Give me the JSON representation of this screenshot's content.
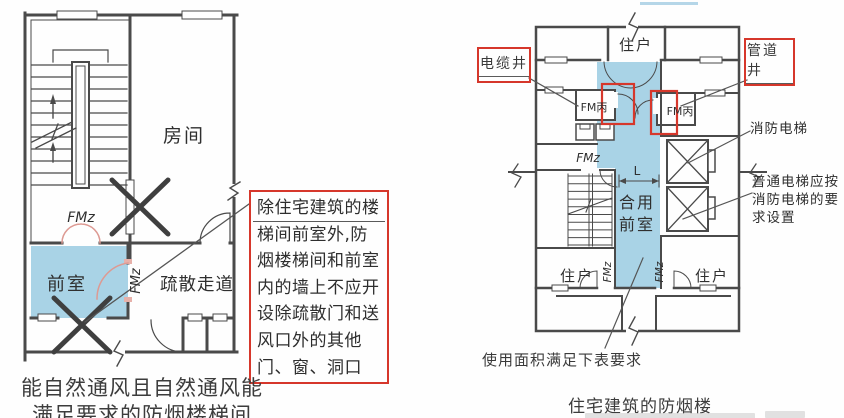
{
  "colors": {
    "wall": "#4a4a4a",
    "blue_fill": "#a9d3e6",
    "annotation_red": "#d6372b",
    "door_pink": "#dd9a93",
    "leader": "#555555"
  },
  "left_plan": {
    "room_label": "房间",
    "front_room_label": "前室",
    "corridor_label": "疏散走道",
    "door_top_label": "FMz",
    "door_side_label": "FMz",
    "caption_line1": "能自然通风且自然通风能",
    "caption_line2": "满足要求的防烟楼梯间"
  },
  "annotation_box": {
    "lines": [
      "除住宅建筑的楼",
      "梯间前室外,防",
      "烟楼梯间和前室",
      "内的墙上不应开",
      "设除疏散门和送",
      "风口外的其他",
      "门、窗、洞口"
    ]
  },
  "right_plan": {
    "resident_top_label": "住户",
    "cable_shaft_label": "电缆井",
    "pipe_shaft_label": "管道井",
    "fm_bing_left_label": "FM丙",
    "fm_bing_right_label": "FM丙",
    "stair_door_label": "FMz",
    "dimension_label": "L",
    "shared_front_room_line1": "合用",
    "shared_front_room_line2": "前室",
    "fire_elevator_label": "消防电梯",
    "elevator_note_line1": "普通电梯应按",
    "elevator_note_line2": "消防电梯的要",
    "elevator_note_line3": "求设置",
    "bottom_door_left_label": "FMz",
    "bottom_door_right_label": "FMz",
    "resident_bottom_left_label": "住户",
    "resident_bottom_right_label": "住户",
    "area_note": "使用面积满足下表要求",
    "caption": "住宅建筑的防烟楼"
  }
}
